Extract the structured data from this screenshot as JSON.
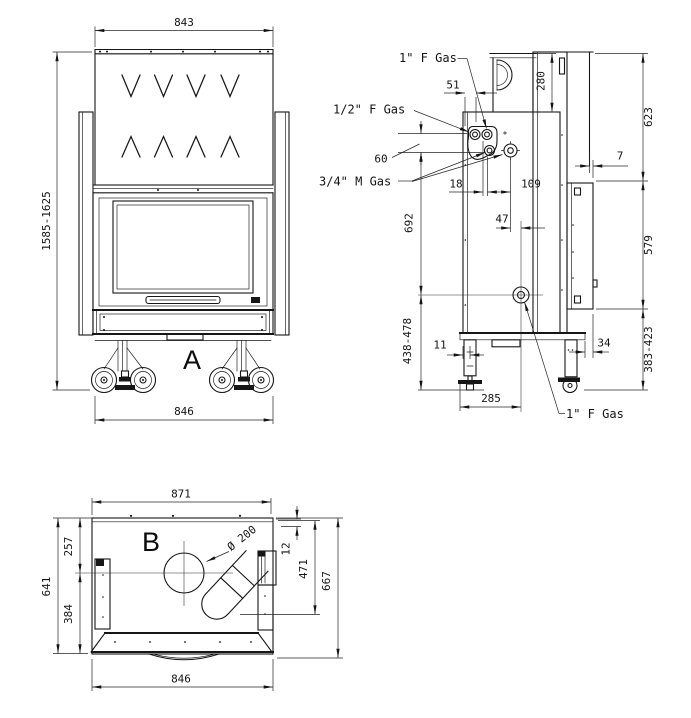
{
  "front": {
    "label": "A",
    "dims": {
      "top_width": "843",
      "height_range": "1585-1625",
      "bottom_width": "846"
    }
  },
  "side": {
    "labels": {
      "gas_top": "1\" F Gas",
      "gas_half": "1/2\" F Gas",
      "gas_three_quarter": "3/4\" M Gas",
      "gas_bottom": "1\" F Gas"
    },
    "dims": {
      "d51": "51",
      "d280": "280",
      "d623": "623",
      "d60": "60",
      "d7": "7",
      "d18": "18",
      "d109": "109",
      "d692": "692",
      "d47": "47",
      "d579": "579",
      "d438_478": "438-478",
      "d11": "11",
      "d34": "34",
      "d383_423": "383-423",
      "d285": "285"
    }
  },
  "plan": {
    "label": "B",
    "dims": {
      "top_width": "871",
      "bottom_width": "846",
      "left_upper": "257",
      "left_total": "641",
      "left_lower": "384",
      "right_small": "12",
      "right_inner": "471",
      "right_total": "667",
      "flue_diameter": "Ø 200"
    }
  },
  "colors": {
    "line": "#161616",
    "background": "#ffffff"
  }
}
